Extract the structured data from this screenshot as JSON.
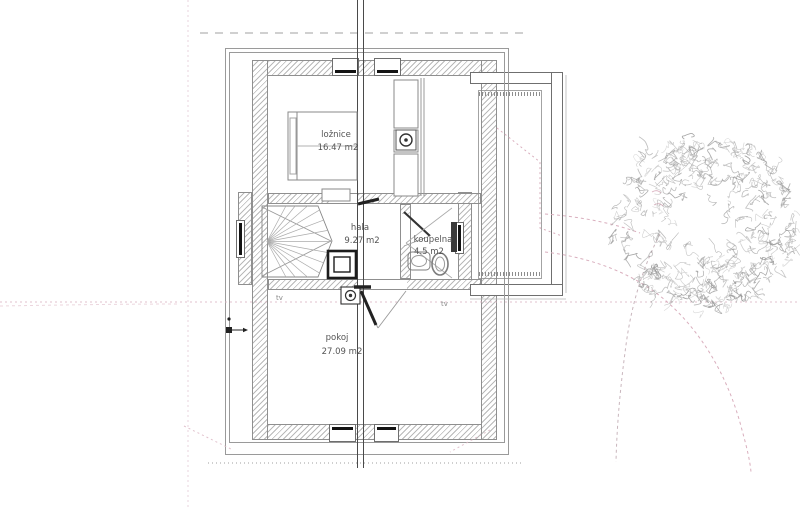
{
  "plan": {
    "rooms": [
      {
        "name": "ložnice",
        "area": "16.47 m2"
      },
      {
        "name": "hala",
        "area": "9.27 m2"
      },
      {
        "name": "koupelna",
        "area": "4.5 m2"
      },
      {
        "name": "pokoj",
        "area": "27.09 m2"
      }
    ],
    "outlets": {
      "left": "tv",
      "right": "tv"
    }
  },
  "colors": {
    "drawing_line": "#4a4a4a",
    "wall_hatch": "#b9b9b9",
    "reference_dash_pink": "#d9aebd",
    "tree_gray": "#9a9a9a",
    "label_text": "#555555"
  }
}
